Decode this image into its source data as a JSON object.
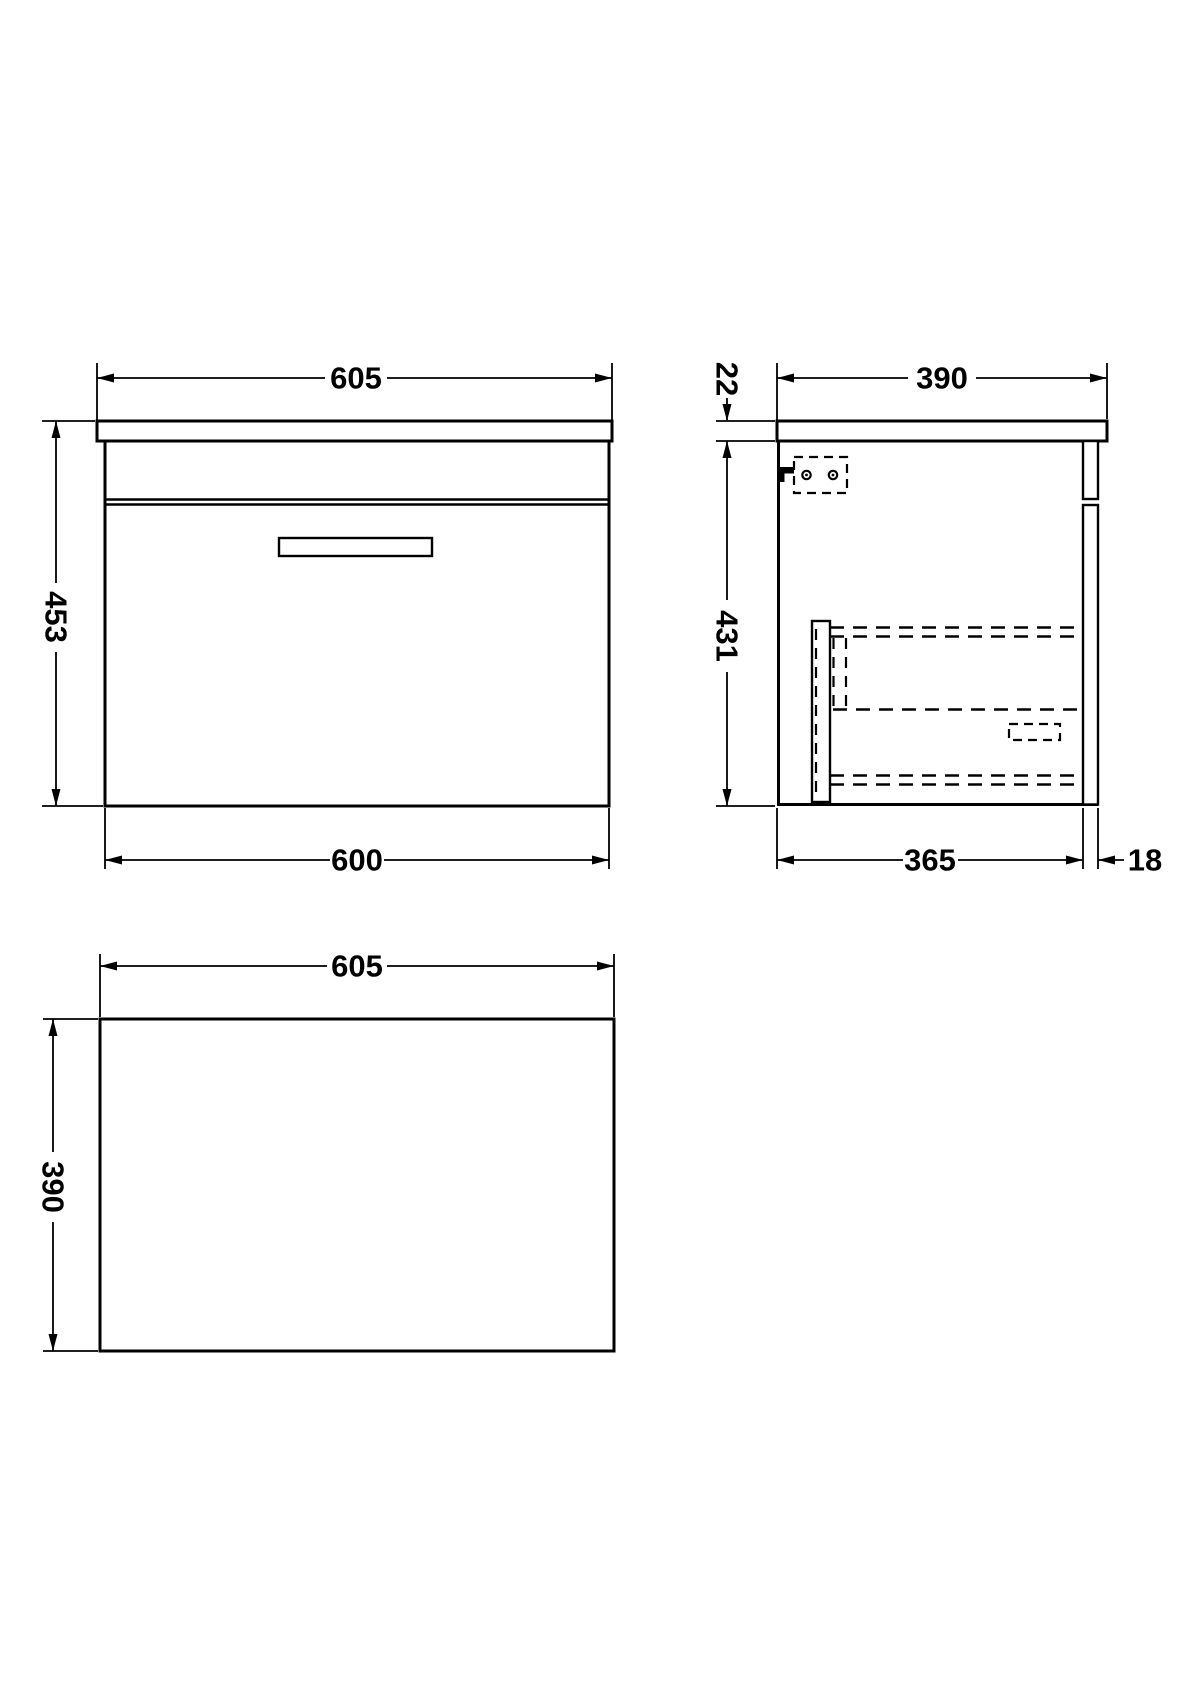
{
  "drawing": {
    "background": "#ffffff",
    "line_color": "#000000",
    "front_view": {
      "width_top": "605",
      "height": "453",
      "width_bottom": "600"
    },
    "side_view": {
      "depth_top": "390",
      "countertop_thickness": "22",
      "cabinet_height": "431",
      "body_depth": "365",
      "drawer_front_thickness": "18"
    },
    "plan_view": {
      "width": "605",
      "depth": "390"
    }
  }
}
